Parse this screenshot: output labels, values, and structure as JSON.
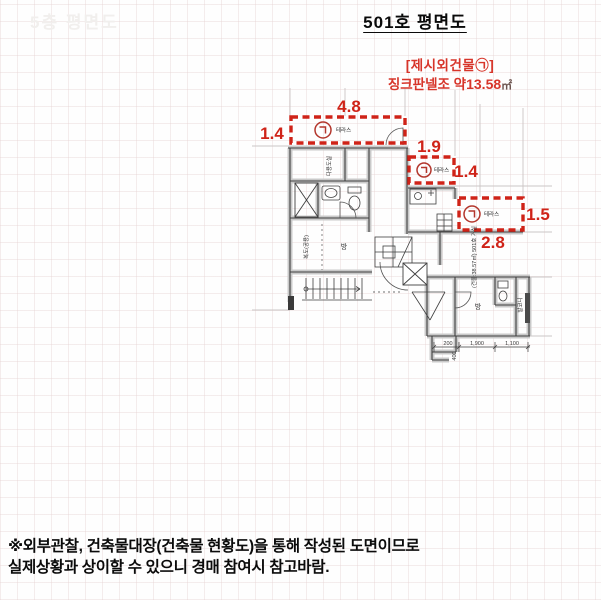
{
  "page": {
    "watermark": "5층 평면도",
    "title": "501호 평면도"
  },
  "annotation": {
    "line1": "[제시외건물㉠]",
    "line2_prefix": "징크판넬조 약",
    "line2_value": "13.58",
    "line2_unit": "㎡"
  },
  "terraces": [
    {
      "symbol": "㉠",
      "label": "테라스",
      "width": "4.8",
      "depth": "1.4"
    },
    {
      "symbol": "㉠",
      "label": "테라스",
      "width": "1.9",
      "depth": "1.4"
    },
    {
      "symbol": "㉠",
      "label": "테라스",
      "width": "2.8",
      "depth": "1.5"
    }
  ],
  "plan": {
    "utility_room": "다용도실",
    "corridor": "복도(공용)",
    "room_a": "방",
    "room_b": "방",
    "unit_info": "(건물:38.57㎡) 501호 거실",
    "balcony": "발코니",
    "dim_200": "200",
    "dim_400": "400",
    "dim_1900": "1,900",
    "dim_1100": "1,100"
  },
  "footer": {
    "line1": "※외부관찰, 건축물대장(건축물 현황도)을 통해 작성된 도면이므로",
    "line2": "실제상황과 상이할 수 있으니 경매 참여시 참고바람."
  },
  "colors": {
    "annotation_red": "#cf2318",
    "line_dark": "#3f3f3f",
    "wall_gray": "#c9c9c9"
  }
}
